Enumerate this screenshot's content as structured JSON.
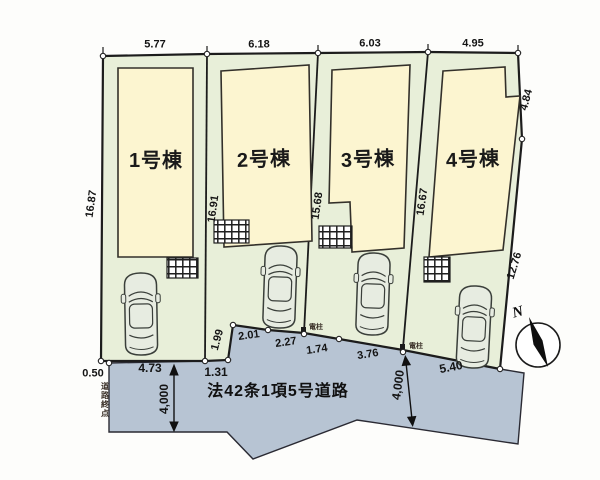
{
  "plan": {
    "buildings": [
      {
        "label": "1号棟",
        "top_width": "5.77"
      },
      {
        "label": "2号棟",
        "top_width": "6.18"
      },
      {
        "label": "3号棟",
        "top_width": "6.03"
      },
      {
        "label": "4号棟",
        "top_width": "4.95"
      }
    ],
    "depth_dims": [
      "16.87",
      "16.91",
      "15.68",
      "16.67"
    ],
    "right_dims": {
      "upper": "4.84",
      "lower": "12.76"
    },
    "frontage_dims": {
      "lot1": "4.73",
      "lot2_left": "1.31",
      "step": "1.99",
      "seg1": "2.01",
      "seg2": "2.27",
      "seg3": "1.74",
      "seg4": "3.76",
      "lot4": "5.40"
    },
    "corner_offset": "0.50",
    "road": {
      "name": "法42条1項5号道路",
      "width_left": "4,000",
      "width_right": "4,000",
      "end_label": "道路終点"
    },
    "utility_pole": "電柱",
    "compass_north": "N",
    "colors": {
      "lot_green": "#e8efd9",
      "building_cream": "#fcf5d0",
      "road_blue": "#b7c4d3",
      "outline": "#1c1c1c"
    }
  }
}
